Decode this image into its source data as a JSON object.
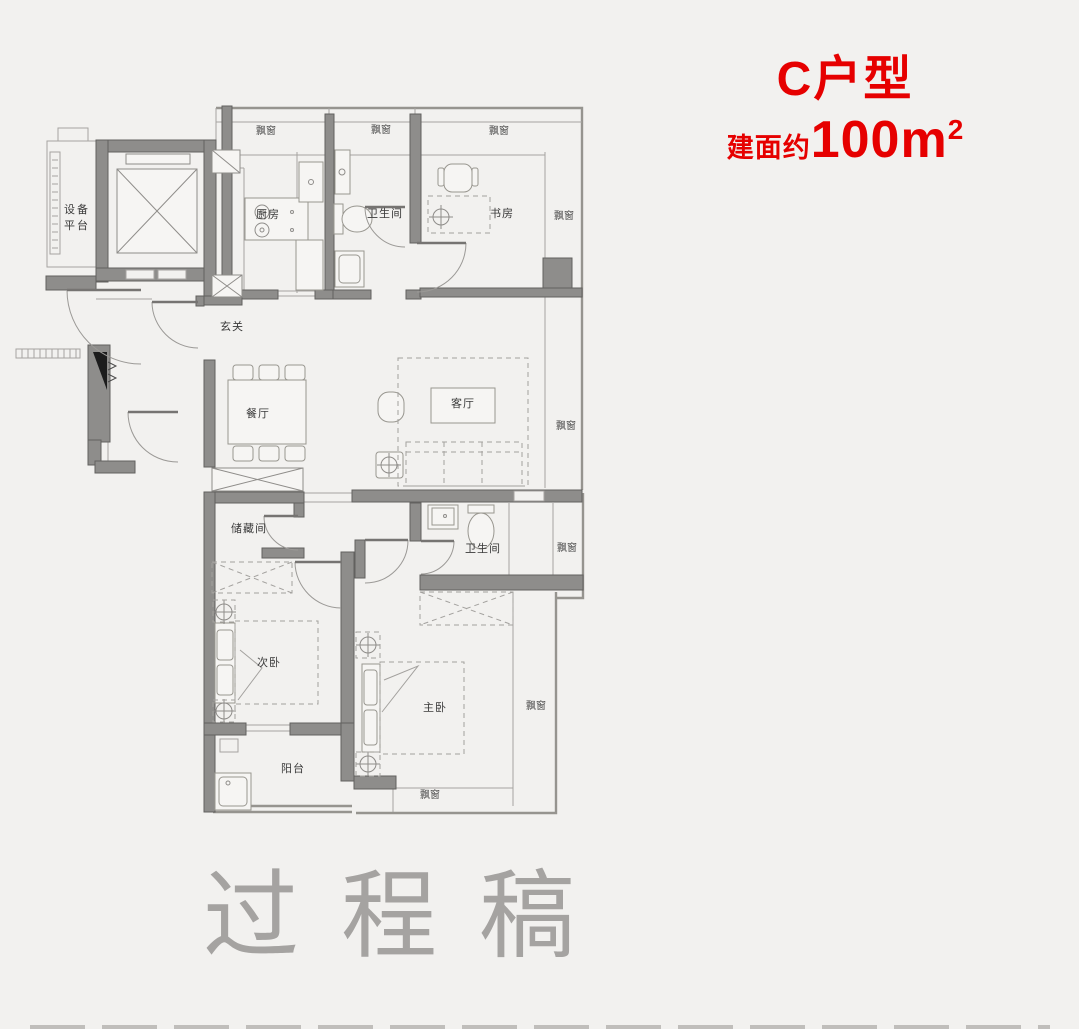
{
  "header": {
    "unit_name": "C户型",
    "area_prefix": "建面约",
    "area_number": "100m",
    "area_exponent": "2"
  },
  "watermark": "过程稿",
  "colors": {
    "accent": "#e60000",
    "wall": "#8e8d8b",
    "background": "#f2f1ef"
  },
  "floor_plan": {
    "rooms": {
      "equipment_platform": "设备平台",
      "kitchen": "厨房",
      "bathroom_upper": "卫生间",
      "study": "书房",
      "foyer": "玄关",
      "dining_room": "餐厅",
      "living_room": "客厅",
      "storage_room": "储藏间",
      "bathroom_lower": "卫生间",
      "secondary_bedroom": "次卧",
      "master_bedroom": "主卧",
      "balcony": "阳台",
      "bay_window": "飘窗"
    }
  }
}
